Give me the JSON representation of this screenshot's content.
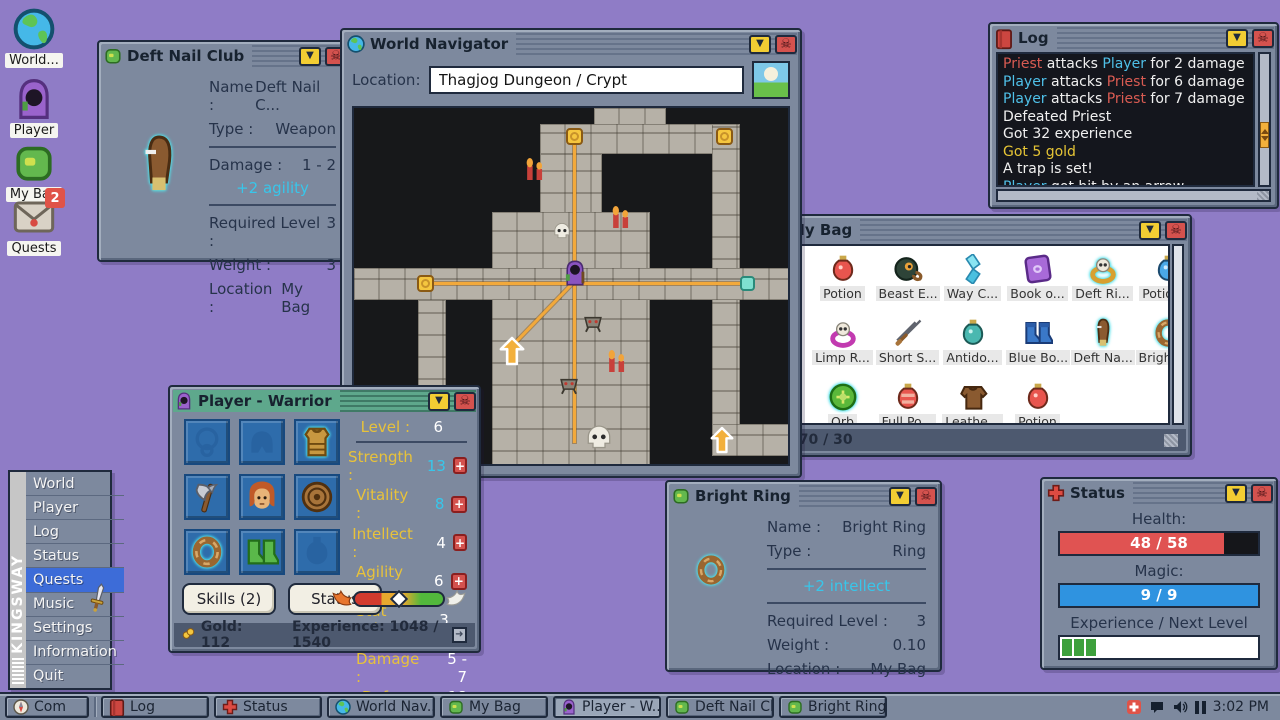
{
  "desktop": {
    "icons": [
      {
        "icon": "globe",
        "name": "world",
        "label": "World..."
      },
      {
        "icon": "player",
        "name": "player",
        "label": "Player"
      },
      {
        "icon": "bag",
        "name": "my-bag",
        "label": "My Bag"
      },
      {
        "icon": "envelope",
        "name": "quests",
        "label": "Quests",
        "badge": "2"
      }
    ]
  },
  "start_menu": {
    "brand": "KINGSWAY",
    "items": [
      {
        "label": "World"
      },
      {
        "label": "Player"
      },
      {
        "label": "Log"
      },
      {
        "label": "Status"
      },
      {
        "label": "Quests",
        "active": true
      },
      {
        "label": "Music"
      },
      {
        "label": "Settings"
      },
      {
        "label": "Information"
      },
      {
        "label": "Quit"
      }
    ]
  },
  "deft_window": {
    "title": "Deft Nail Club",
    "name_label": "Name :",
    "name": "Deft Nail C...",
    "type_label": "Type :",
    "type": "Weapon",
    "damage_label": "Damage :",
    "damage": "1 - 2",
    "bonus": "+2  agility",
    "req_label": "Required Level :",
    "req": "3",
    "weight_label": "Weight :",
    "weight": "3",
    "loc_label": "Location :",
    "loc": "My Bag"
  },
  "navigator": {
    "title": "World Navigator",
    "location_label": "Location:",
    "location_value": "Thagjog Dungeon / Crypt"
  },
  "log_window": {
    "title": "Log",
    "lines": [
      [
        {
          "t": "Priest",
          "c": "red"
        },
        {
          "t": " attacks ",
          "c": "w"
        },
        {
          "t": "Player",
          "c": "cyan"
        },
        {
          "t": " for 2 damage",
          "c": "w"
        }
      ],
      [
        {
          "t": "Player",
          "c": "cyan"
        },
        {
          "t": " attacks ",
          "c": "w"
        },
        {
          "t": "Priest",
          "c": "red"
        },
        {
          "t": " for 6 damage",
          "c": "w"
        }
      ],
      [
        {
          "t": "Player",
          "c": "cyan"
        },
        {
          "t": " attacks ",
          "c": "w"
        },
        {
          "t": "Priest",
          "c": "red"
        },
        {
          "t": " for 7 damage",
          "c": "w"
        }
      ],
      [
        {
          "t": "Defeated Priest",
          "c": "w"
        }
      ],
      [
        {
          "t": "Got 32 experience",
          "c": "w"
        }
      ],
      [
        {
          "t": "Got 5 gold",
          "c": "gold"
        }
      ],
      [
        {
          "t": "A trap is set!",
          "c": "w"
        }
      ],
      [
        {
          "t": "Player",
          "c": "cyan"
        },
        {
          "t": " got hit by an arrow",
          "c": "w"
        }
      ]
    ]
  },
  "bag_window": {
    "title": "My Bag",
    "status": "29.70 / 30",
    "items": [
      {
        "icon": "potion_red",
        "name": "Potion"
      },
      {
        "icon": "bomb",
        "name": "Beast E..."
      },
      {
        "icon": "crystal",
        "name": "Way C..."
      },
      {
        "icon": "book_purple",
        "name": "Book o..."
      },
      {
        "icon": "ring_skull_gold",
        "name": "Deft Ri...",
        "glow": true
      },
      {
        "icon": "potion_blue",
        "name": "Potion..."
      },
      {
        "icon": "ring_skull_magenta",
        "name": "Limp R..."
      },
      {
        "icon": "sword",
        "name": "Short S..."
      },
      {
        "icon": "flask_teal",
        "name": "Antido..."
      },
      {
        "icon": "boots_blue",
        "name": "Blue Bo..."
      },
      {
        "icon": "club",
        "name": "Deft Na...",
        "glow": true
      },
      {
        "icon": "ring_plain",
        "name": "Bright R...",
        "glow": true
      },
      {
        "icon": "orb",
        "name": "Orb",
        "glow": true
      },
      {
        "icon": "potion_full",
        "name": "Full Po..."
      },
      {
        "icon": "armor_leather",
        "name": "Leathe..."
      },
      {
        "icon": "potion_red",
        "name": "Potion"
      }
    ]
  },
  "player_window": {
    "title": "Player - Warrior",
    "level_label": "Level :",
    "level": "6",
    "stats": [
      {
        "key": "strength",
        "label": "Strength :",
        "value": "13",
        "hl": true
      },
      {
        "key": "vitality",
        "label": "Vitality :",
        "value": "8",
        "hl": true
      },
      {
        "key": "intellect",
        "label": "Intellect :",
        "value": "4"
      },
      {
        "key": "agility",
        "label": "Agility :",
        "value": "6"
      }
    ],
    "stat_points_label": "Stat Points :",
    "stat_points": "3",
    "damage_label": "Damage :",
    "damage": "5 - 7",
    "defence_label": "Defence :",
    "defence": "18",
    "skills_button": "Skills (2)",
    "status_button": "Status",
    "gold": "Gold: 112",
    "experience": "Experience: 1048 / 1540",
    "equipment": [
      {
        "icon": "amulet",
        "name": "amulet-slot",
        "faint": true
      },
      {
        "icon": "helmet",
        "name": "helmet-slot",
        "faint": true
      },
      {
        "icon": "armor_gold",
        "name": "armor-equipped",
        "glow": true
      },
      {
        "icon": "axe",
        "name": "axe-equipped"
      },
      {
        "icon": "portrait",
        "name": "player-portrait"
      },
      {
        "icon": "shield",
        "name": "shield-equipped"
      },
      {
        "icon": "ring_plain",
        "name": "ring-equipped",
        "glow": true
      },
      {
        "icon": "boots_green",
        "name": "boots-equipped"
      },
      {
        "icon": "potion_faint",
        "name": "potion-slot",
        "faint": true
      }
    ]
  },
  "bright_window": {
    "title": "Bright Ring",
    "name_label": "Name :",
    "name": "Bright Ring",
    "type_label": "Type :",
    "type": "Ring",
    "bonus": "+2  intellect",
    "req_label": "Required Level :",
    "req": "3",
    "weight_label": "Weight :",
    "weight": "0.10",
    "loc_label": "Location :",
    "loc": "My Bag"
  },
  "status_window": {
    "title": "Status",
    "health_label": "Health:",
    "health_value": "48 / 58",
    "magic_label": "Magic:",
    "magic_value": "9 / 9",
    "exp_label": "Experience / Next Level",
    "exp_segments": 3
  },
  "taskbar": {
    "buttons": [
      {
        "icon": "compass",
        "label": "Com",
        "start": true
      },
      {
        "icon": "book",
        "label": "Log"
      },
      {
        "icon": "cross",
        "label": "Status"
      },
      {
        "icon": "globe",
        "label": "World Nav..."
      },
      {
        "icon": "bag",
        "label": "My Bag"
      },
      {
        "icon": "player",
        "label": "Player - W...",
        "active": true
      },
      {
        "icon": "bag",
        "label": "Deft Nail Cl.."
      },
      {
        "icon": "bag",
        "label": "Bright Ring"
      }
    ],
    "time": "3:02 PM"
  },
  "colors": {
    "desktop": "#8f7cc6",
    "window": "#7d899e",
    "active_title": "#5ea88c",
    "accent_cyan": "#38c6ea",
    "stat_yellow": "#e8c23a",
    "health_red": "#e05352",
    "magic_blue": "#2f93e0",
    "exp_green": "#3da03c",
    "log_red": "#d95b52",
    "log_cyan": "#4fc0e8",
    "log_gold": "#e6c535",
    "path_orange": "#f2a93b"
  }
}
